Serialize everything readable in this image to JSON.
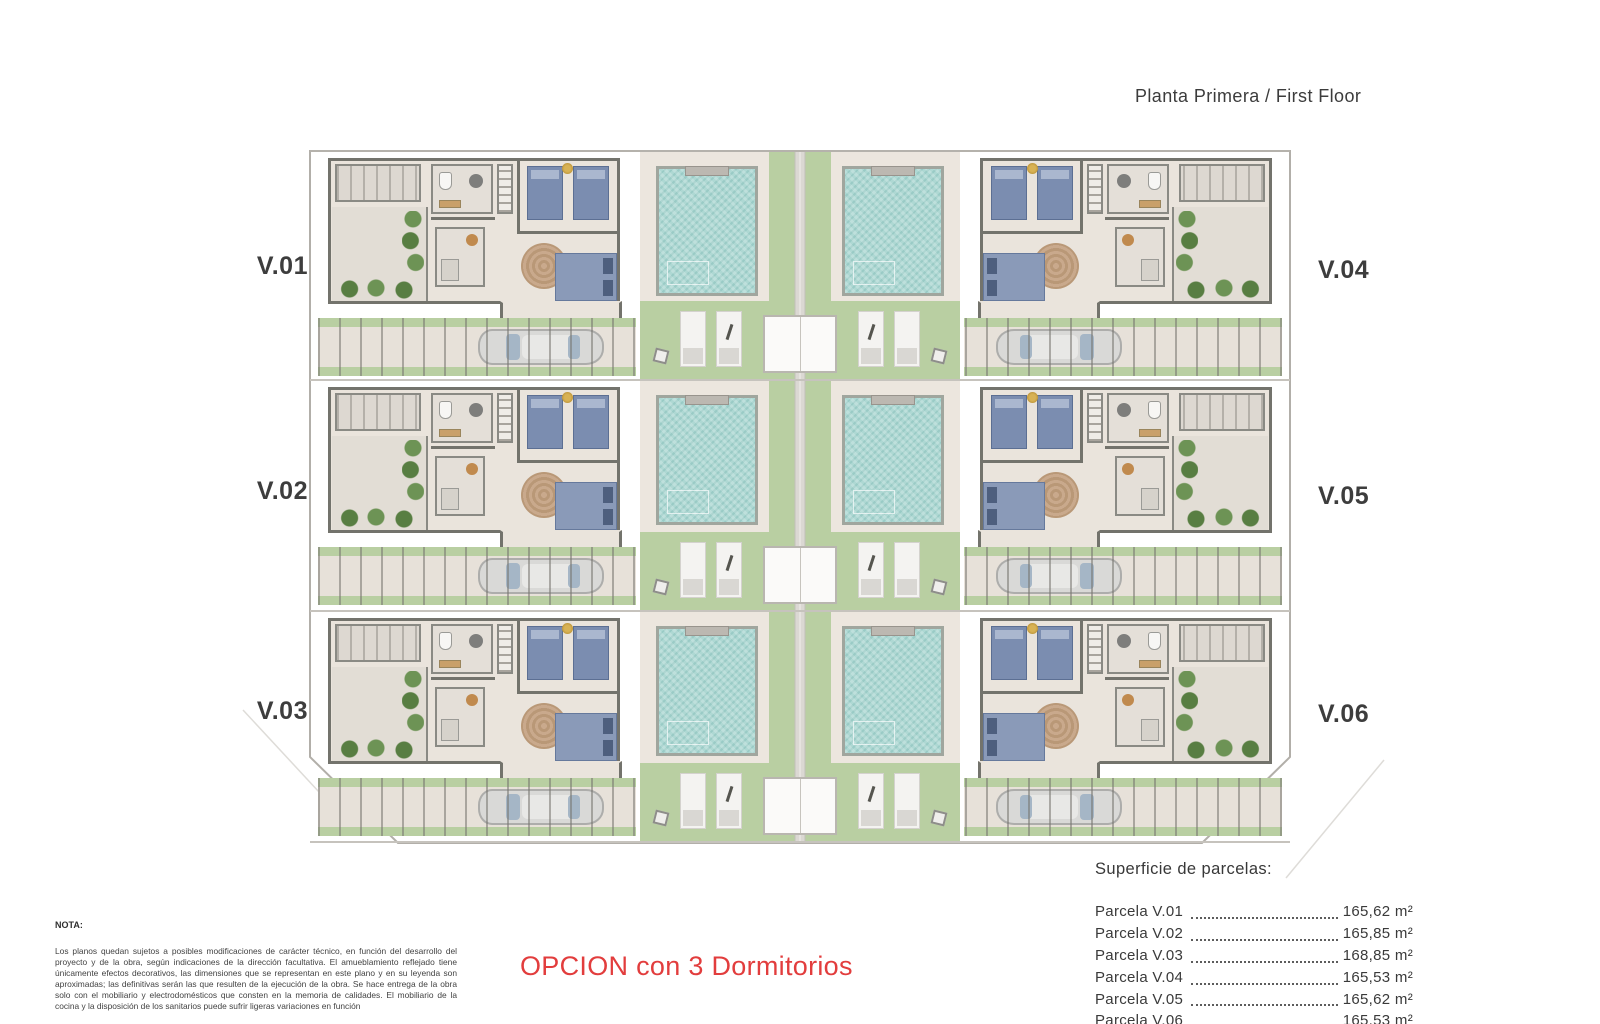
{
  "title": "Planta Primera / First Floor",
  "plan": {
    "unit_labels": [
      "V.01",
      "V.02",
      "V.03",
      "V.04",
      "V.05",
      "V.06"
    ]
  },
  "nota": {
    "heading": "NOTA:",
    "body": "Los planos quedan sujetos a posibles modificaciones de carácter técnico, en función del desarrollo del proyecto y de la obra, según indicaciones de la dirección facultativa. El amueblamiento reflejado tiene únicamente efectos decorativos, las dimensiones que se representan en este plano y en su leyenda son aproximadas; las definitivas serán las que resulten de la ejecución de la obra. Se hace entrega de la obra solo con el mobiliario y electrodomésticos que consten en la memoria de calidades. El mobiliario de la cocina y la disposición de los sanitarios puede sufrir ligeras variaciones en función"
  },
  "option_label": "OPCION con 3 Dormitorios",
  "legend": {
    "heading": "Superficie de parcelas:",
    "rows": [
      {
        "label": "Parcela V.01",
        "area": "165,62 m²"
      },
      {
        "label": "Parcela V.02",
        "area": "165,85 m²"
      },
      {
        "label": "Parcela V.03",
        "area": "168,85 m²"
      },
      {
        "label": "Parcela V.04",
        "area": "165,53 m²"
      },
      {
        "label": "Parcela V.05",
        "area": "165,62 m²"
      },
      {
        "label": "Parcela V.06",
        "area": "165,53 m²"
      }
    ]
  },
  "colors": {
    "pool": "#aed8d3",
    "grass": "#b9cfa2",
    "floor": "#eae4dc",
    "wall": "#73736c",
    "bed_blue": "#7b8db0",
    "accent_red": "#e23d3d"
  }
}
